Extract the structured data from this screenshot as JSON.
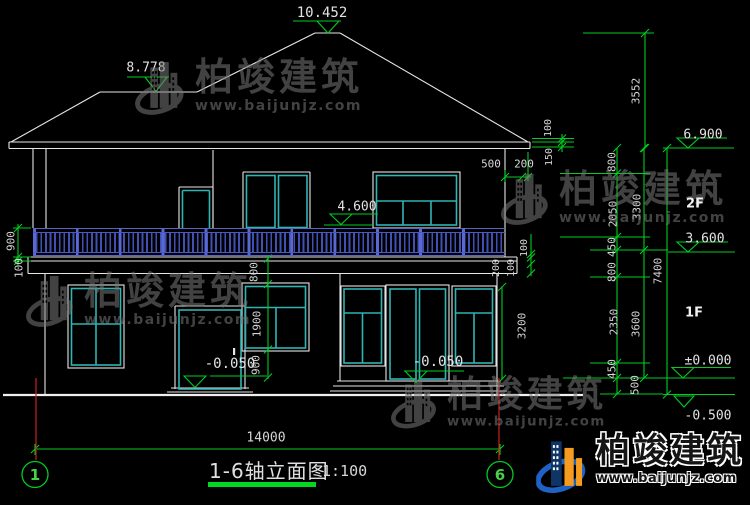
{
  "watermark": {
    "company": "柏竣建筑",
    "website": "www.baijunjz.com"
  },
  "logo": {
    "company": "柏竣建筑",
    "website": "www.baijunjz.com"
  },
  "title": {
    "text": "1-6轴立面图",
    "scale": "1:100"
  },
  "axis_markers": {
    "left": "1",
    "right": "6"
  },
  "floor_labels": {
    "second_floor": "2F",
    "first_floor": "1F"
  },
  "elevation_markers": {
    "roof_peak": "10.452",
    "porch_roof": "8.778",
    "main_eave": "6.900",
    "balcony": "4.600",
    "second_floor": "3.600",
    "ground_floor": "±0.000",
    "site_ground": "-0.500",
    "entry_left": "-0.050",
    "entry_right": "-0.050"
  },
  "dimensions": {
    "overall_width": "14000",
    "roof_to_eave": "3552",
    "eave_detail_upper": "100",
    "eave_detail_lower": "150",
    "eave_overhang": "500",
    "eave_overhang_outer": "200",
    "right_chain": [
      "800",
      "2050",
      "450",
      "800",
      "2350",
      "450",
      "500"
    ],
    "storey_upper": "3300",
    "storey_lower": "3600",
    "total_height": "7400",
    "railing_height": "900",
    "balcony_slab": "100",
    "window_top": "800",
    "window_height": "1900",
    "window_sill": "900",
    "right_opening_height": "3200",
    "slab_detail": [
      "100",
      "200",
      "100"
    ]
  }
}
